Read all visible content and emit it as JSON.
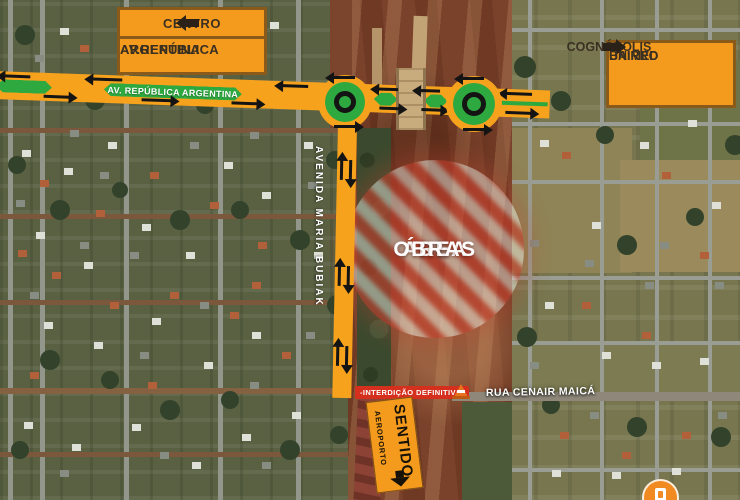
{
  "map_title": "Mapa de interdição de obras - Av. República Argentina",
  "signs": {
    "centro": {
      "destination": "CENTRO",
      "road_line1": "AV.REPÚBLICA",
      "road_line2": "ARGENTINA",
      "arrow": "left"
    },
    "bairro": {
      "line1": "BAIRRO",
      "line2": "COGNÓPOLIS",
      "line3": "UNIMED",
      "arrow": "right"
    },
    "sentido": {
      "line1": "SENTIDO",
      "line2": "AEROPORTO",
      "arrow": "down"
    }
  },
  "roads": {
    "avenue_band_label": "AV. REPÚBLICA ARGENTINA",
    "vertical_avenue_label": "AVENIDA MARIA BUBIAK",
    "street_label": "RUA CENAIR MAICÁ",
    "closure_label": "-INTERDIÇÃO DEFINITIVA-"
  },
  "work_zone": {
    "line1": "ÁREA",
    "line2": "DE",
    "line3": "OBRAS"
  },
  "colors": {
    "overlay_orange": "#F6A21D",
    "sign_orange": "#F49A1C",
    "sign_border": "#8A5A1A",
    "median_green": "#2EA93F",
    "closure_red": "#D5301D",
    "closed_road_maroon": "#8C4336",
    "hazard_stripe_red": "#C63E2C",
    "construction_dirt": "#7B422B"
  }
}
